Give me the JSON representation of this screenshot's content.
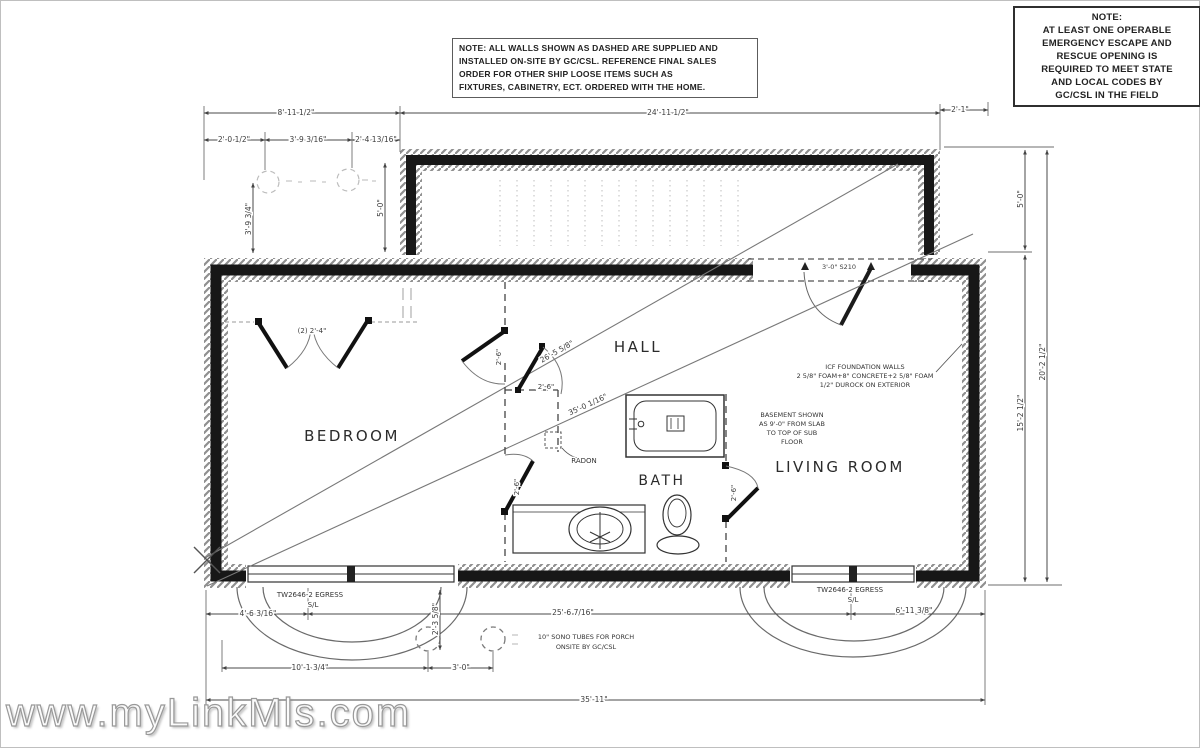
{
  "notes": {
    "wall_note": {
      "lines": [
        "NOTE: ALL WALLS SHOWN AS DASHED ARE SUPPLIED AND",
        "INSTALLED ON-SITE BY GC/CSL.  REFERENCE FINAL SALES",
        "ORDER FOR OTHER SHIP LOOSE ITEMS SUCH AS",
        "FIXTURES, CABINETRY, ECT. ORDERED WITH THE HOME."
      ]
    },
    "egress_note": {
      "lines": [
        "NOTE:",
        "AT LEAST ONE OPERABLE",
        "EMERGENCY ESCAPE AND",
        "RESCUE OPENING IS",
        "REQUIRED TO MEET STATE",
        "AND LOCAL CODES BY",
        "GC/CSL IN THE FIELD"
      ]
    }
  },
  "rooms": {
    "bedroom": "BEDROOM",
    "hall": "HALL",
    "bath": "BATH",
    "living_room": "LIVING ROOM"
  },
  "annotations": {
    "icf_note": {
      "lines": [
        "ICF FOUNDATION WALLS",
        "2 5/8\" FOAM+8\" CONCRETE+2 5/8\" FOAM",
        "1/2\" DUROCK ON EXTERIOR"
      ]
    },
    "basement_note": {
      "lines": [
        "BASEMENT SHOWN",
        "AS 9'-0\" FROM SLAB",
        "TO TOP OF SUB",
        "FLOOR"
      ]
    },
    "sono_note": {
      "lines": [
        "10\" SONO TUBES FOR PORCH",
        "ONSITE BY GC/CSL"
      ]
    },
    "radon": "RADON",
    "window_label": "TW2646-2 EGRESS",
    "window_label2": "S/L"
  },
  "dimensions": {
    "top_left_overall": "8'-11 1/2\"",
    "top_sub_1": "2'-0 1/2\"",
    "top_sub_2": "3'-9 3/16\"",
    "top_sub_3": "2'-4 13/16\"",
    "porch_width": "24'-11 1/2\"",
    "right_offset": "2'-1\"",
    "left_vert": "3'-9 3/4\"",
    "porch_depth": "5'-0\"",
    "right_upper": "5'-0\"",
    "right_inner": "15'-2 1/2\"",
    "right_outer": "20'-2 1/2\"",
    "diag_upper": "26'-5 5/8\"",
    "diag_lower": "35'-0 1/16\"",
    "bottom_seg_left": "4'-6 3/16\"",
    "bottom_seg_mid": "25'-6 7/16\"",
    "bottom_seg_right": "6'-11 3/8\"",
    "bottom_small_vert": "2'-3 5/8\"",
    "porch_post_left": "10'-1 3/4\"",
    "porch_post_spacing": "3'-0\"",
    "bottom_overall": "35'-11\"",
    "door_width": "2'-6\"",
    "double_door_width": "(2) 2'-4\"",
    "hall_door": "3'-0\" S210"
  },
  "watermark": "www.myLinkMls.com",
  "colors": {
    "wall": "#171717",
    "line": "#555555",
    "faint": "#c0c0c0",
    "watermark": "#999999"
  }
}
